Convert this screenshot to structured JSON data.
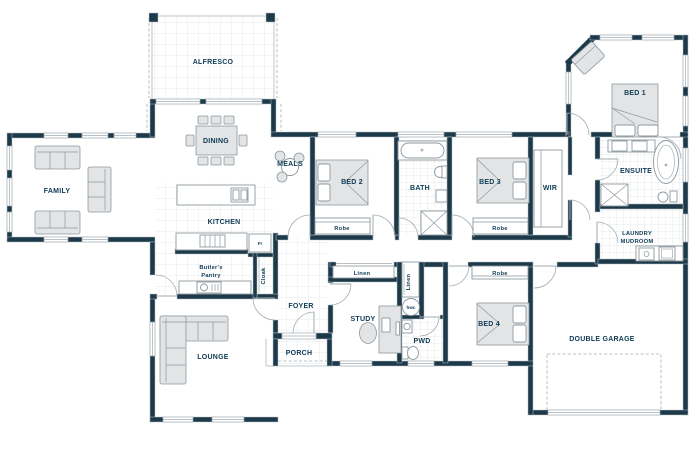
{
  "plan": {
    "title": "Single storey house floor plan",
    "labels": {
      "alfresco": "ALFRESCO",
      "dining": "DINING",
      "family": "FAMILY",
      "meals": "MEALS",
      "kitchen": "KITCHEN",
      "butlers_pantry_line1": "Butler's",
      "butlers_pantry_line2": "Pantry",
      "fridge": "Fr",
      "cloak": "Cloak",
      "foyer": "FOYER",
      "porch": "PORCH",
      "lounge": "LOUNGE",
      "study": "STUDY",
      "pwd": "PWD",
      "hwc": "hwc",
      "linen_hall": "Linen",
      "linen_nook": "Linen",
      "bed1": "BED 1",
      "bed2": "BED 2",
      "bed3": "BED 3",
      "bed4": "BED 4",
      "bath": "BATH",
      "ensuite": "ENSUITE",
      "wir": "WIR",
      "laundry_line1": "LAUNDRY",
      "laundry_line2": "MUDROOM",
      "robe_bed2": "Robe",
      "robe_bed3": "Robe",
      "robe_bed4": "Robe",
      "double_garage": "DOUBLE GARAGE"
    },
    "colors": {
      "background": "#ffffff",
      "wall": "#1d3a4a",
      "label": "#0e3b55",
      "furniture_fill": "#e2e4e5",
      "furniture_stroke": "#8e999e",
      "tile_line": "#dfe4e6",
      "door_arc": "#a2adb2",
      "dashed": "#a2adb2"
    }
  }
}
